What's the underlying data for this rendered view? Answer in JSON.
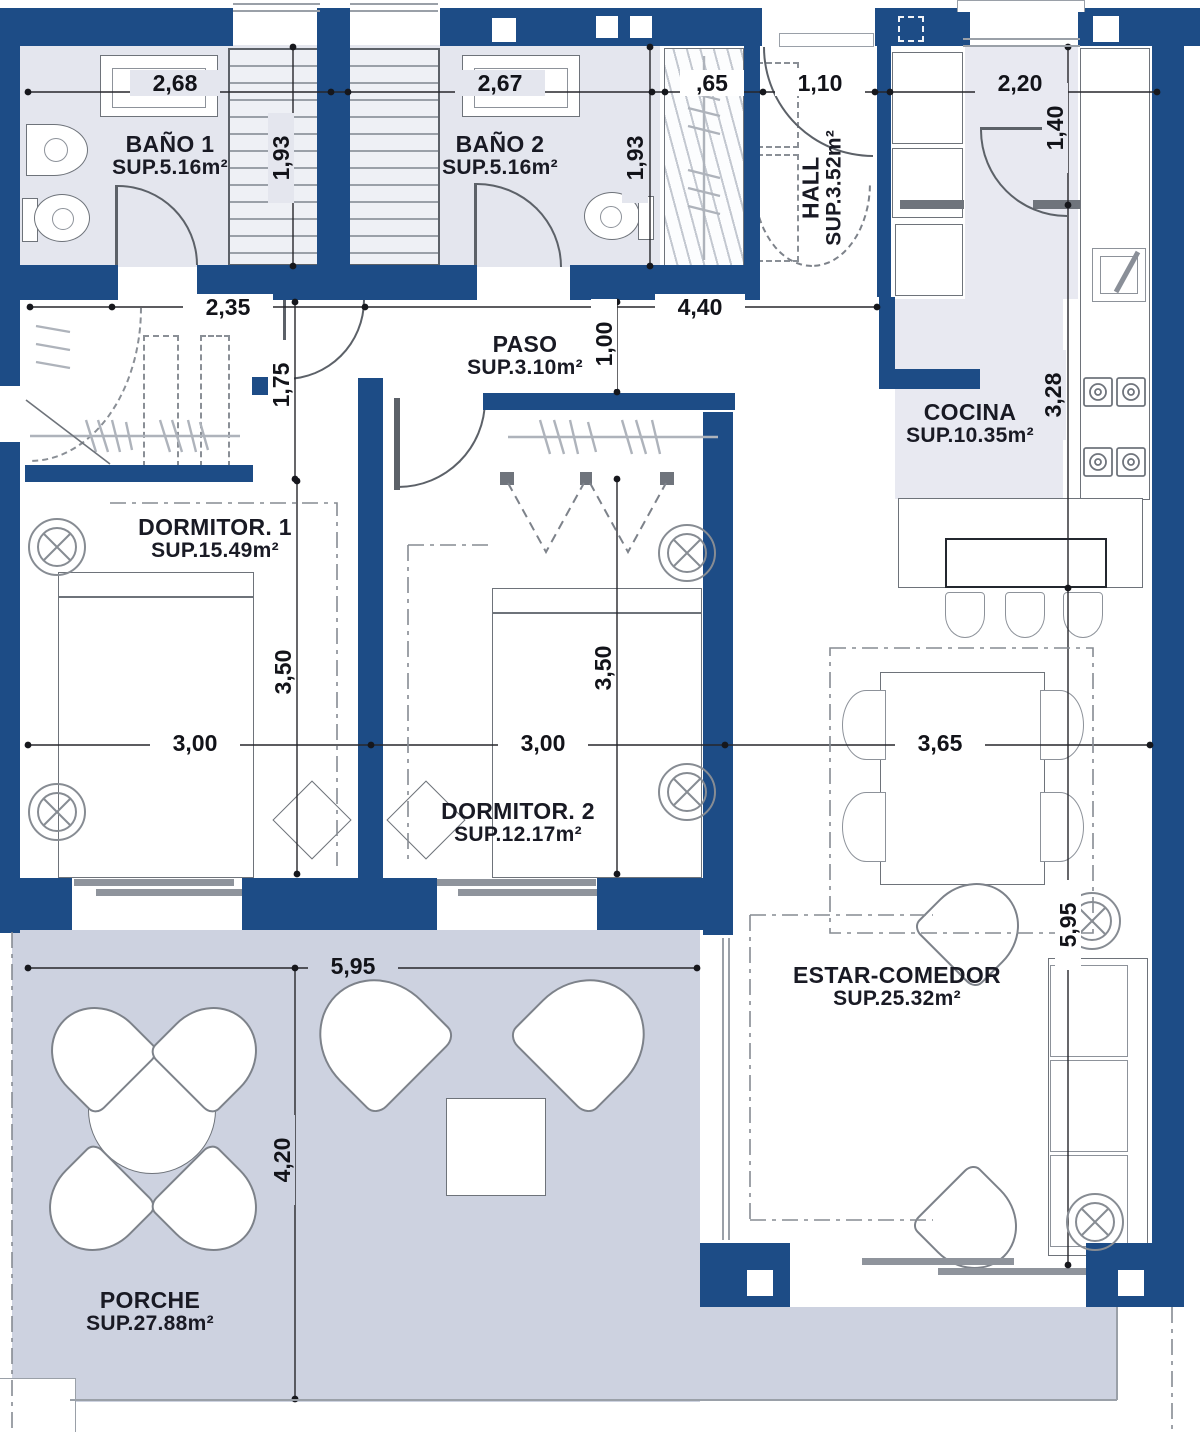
{
  "plan": {
    "rooms": {
      "bano1": {
        "name": "BAÑO 1",
        "area": "SUP.5.16m²"
      },
      "bano2": {
        "name": "BAÑO 2",
        "area": "SUP.5.16m²"
      },
      "hall": {
        "name": "HALL",
        "area": "SUP.3.52m²"
      },
      "paso": {
        "name": "PASO",
        "area": "SUP.3.10m²"
      },
      "cocina": {
        "name": "COCINA",
        "area": "SUP.10.35m²"
      },
      "dormitorio1": {
        "name": "DORMITOR. 1",
        "area": "SUP.15.49m²"
      },
      "dormitorio2": {
        "name": "DORMITOR. 2",
        "area": "SUP.12.17m²"
      },
      "estar": {
        "name": "ESTAR-COMEDOR",
        "area": "SUP.25.32m²"
      },
      "porche": {
        "name": "PORCHE",
        "area": "SUP.27.88m²"
      }
    },
    "dims": {
      "bano1_w": "2,68",
      "bano2_w": "2,67",
      "armario_hall_w": ",65",
      "hall_w": "1,10",
      "cocina_w": "2,20",
      "bano1_h": "1,93",
      "bano2_h": "1,93",
      "cocina_entry_h": "1,40",
      "armario1_w": "2,35",
      "paso_w": "4,40",
      "paso_h": "1,00",
      "armario1_h": "1,75",
      "cocina_h": "3,28",
      "dorm1_h": "3,50",
      "dorm2_h": "3,50",
      "dorm1_w": "3,00",
      "dorm2_w": "3,00",
      "comedor_w": "3,65",
      "porche_w": "5,95",
      "estar_h": "5,95",
      "porche_h": "4,20"
    },
    "colors": {
      "wall": "#1d4c86",
      "bath_floor": "#e4e6ee",
      "kitchen_floor": "#e8e9f1",
      "porch_floor": "#cdd2e0"
    }
  }
}
